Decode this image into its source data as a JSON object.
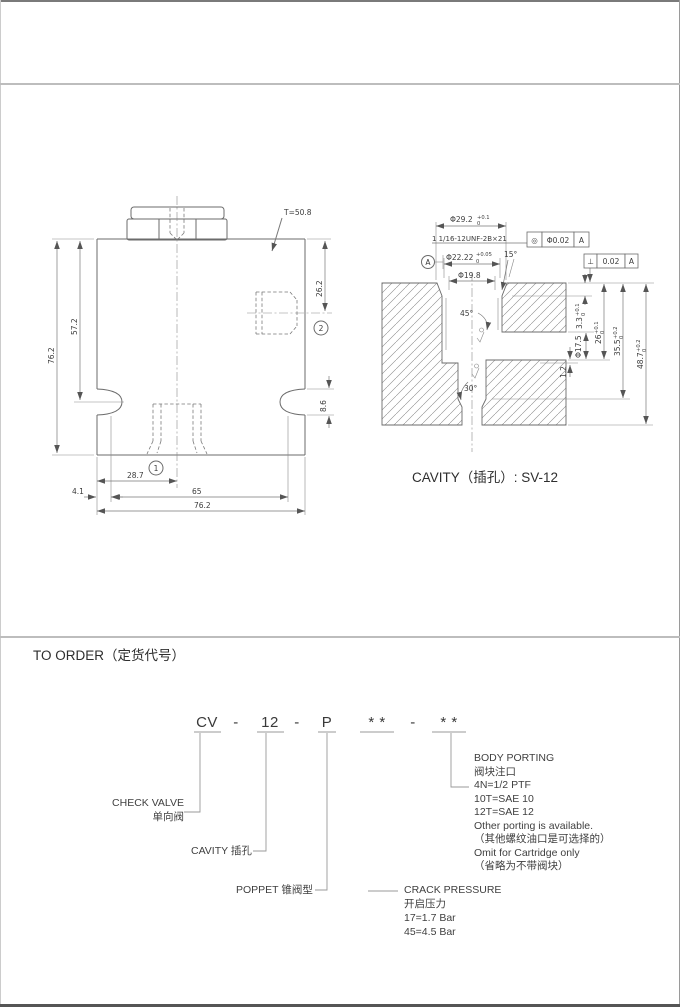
{
  "page": {
    "background": "#ffffff"
  },
  "outline_view": {
    "torque_note": "T=50.8",
    "balloon_port1": "1",
    "balloon_port2": "2",
    "dims": {
      "overall_height": "76.2",
      "top_to_hole": "57.2",
      "top_to_port2": "26.2",
      "hole_height": "8.6",
      "port1_offset": "28.7",
      "hole_span": "65",
      "overall_width": "76.2",
      "edge_to_hole": "4.1"
    }
  },
  "cavity_view": {
    "title": "CAVITY（插孔）: SV-12",
    "thread_callout": "1 1/16-12UNF-2B×21",
    "dims": {
      "spotface_dia": {
        "base": "Φ29.2",
        "sup": "+0.1",
        "sub": "0"
      },
      "pilot_dia": {
        "base": "Φ22.22",
        "sup": "+0.05",
        "sub": "0"
      },
      "bore_dia": "Φ19.8",
      "lead_angle": "15°",
      "seat_angle": "45°",
      "bottom_angle": "30°",
      "port_dia": "Φ17.5",
      "step_depth": {
        "base": "3.3",
        "sup": "+0.1",
        "sub": "0"
      },
      "thread_depth": {
        "base": "26",
        "sup": "+0.1",
        "sub": "0"
      },
      "pilot_depth": {
        "base": "35.5",
        "sup": "+0.2",
        "sub": "0"
      },
      "full_depth": {
        "base": "48.7",
        "sup": "+0.2",
        "sub": "0"
      },
      "port_step": "1.2"
    },
    "gdt": {
      "concentricity": {
        "symbol": "◎",
        "tolerance": "Φ0.02",
        "datum": "A"
      },
      "perpendicularity": {
        "symbol": "⊥",
        "tolerance": "0.02",
        "datum": "A"
      },
      "datum_label": "A"
    }
  },
  "order_section": {
    "title": "TO ORDER（定货代号）",
    "code": {
      "model": "CV",
      "sep1": "-",
      "cavity": "12",
      "sep2": "-",
      "poppet": "P",
      "stars1": "* *",
      "sep3": "-",
      "stars2": "* *"
    },
    "callouts": {
      "check_valve_en": "CHECK VALVE",
      "check_valve_zh": "单向阀",
      "cavity_label": "CAVITY  插孔",
      "poppet_label": "POPPET  锥阀型",
      "crack_pressure": {
        "title": "CRACK PRESSURE",
        "subtitle": "开启压力",
        "options": [
          "17=1.7 Bar",
          "45=4.5 Bar"
        ]
      },
      "body_porting": {
        "title": "BODY PORTING",
        "subtitle": "阀块注口",
        "options": [
          "4N=1/2  PTF",
          "10T=SAE  10",
          "12T=SAE  12"
        ],
        "notes": [
          "Other porting is available.",
          "（其他螺纹油口是可选择的）",
          "Omit for Cartridge only",
          "（省略为不带阀块）"
        ]
      }
    }
  }
}
